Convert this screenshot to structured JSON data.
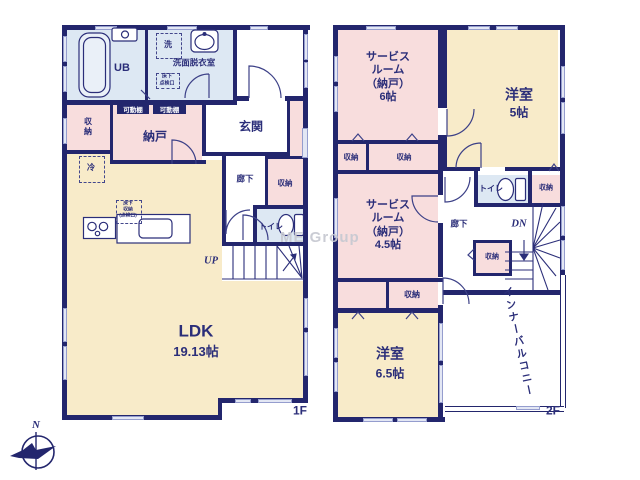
{
  "watermark": "ME Group",
  "compass": {
    "north_label": "N"
  },
  "colors": {
    "wall": "#23266d",
    "text": "#2b2e79",
    "room_pink": "#f8dddd",
    "room_yellow": "#f8ebc9",
    "room_blue": "#dde8f3",
    "window": "#e3e7f4",
    "watermark": "#c8cad2"
  },
  "floor1": {
    "label": "1F",
    "rooms": {
      "ub": "UB",
      "washroom": "洗面脱衣室",
      "laundry": "洗",
      "floor_hatch": "床下\n点検口",
      "shelf_left": "可動棚",
      "shelf_right": "可動棚",
      "closet_west": "収\n納",
      "nando": "納戸",
      "genkan": "玄関",
      "corridor": "廊下",
      "closet_hall": "収納",
      "toilet": "トイレ",
      "fridge": "冷",
      "floor_storage": "床下\n収納\n(点検口)",
      "stairs_up": "UP",
      "ldk": "LDK",
      "ldk_size": "19.13帖"
    }
  },
  "floor2": {
    "label": "2F",
    "rooms": {
      "service6": "サービス\nルーム\n（納戸）\n6帖",
      "yoshitsu5_name": "洋室",
      "yoshitsu5_size": "5帖",
      "closet_a": "収納",
      "closet_b": "収納",
      "service45": "サービス\nルーム\n（納戸）\n4.5帖",
      "toilet": "トイレ",
      "closet_toilet": "収納",
      "corridor": "廊下",
      "stairs_dn": "DN",
      "closet_stairs": "収納",
      "closet_south": "収納",
      "yoshitsu65_name": "洋室",
      "yoshitsu65_size": "6.5帖",
      "balcony": "インナーバルコニー"
    }
  }
}
